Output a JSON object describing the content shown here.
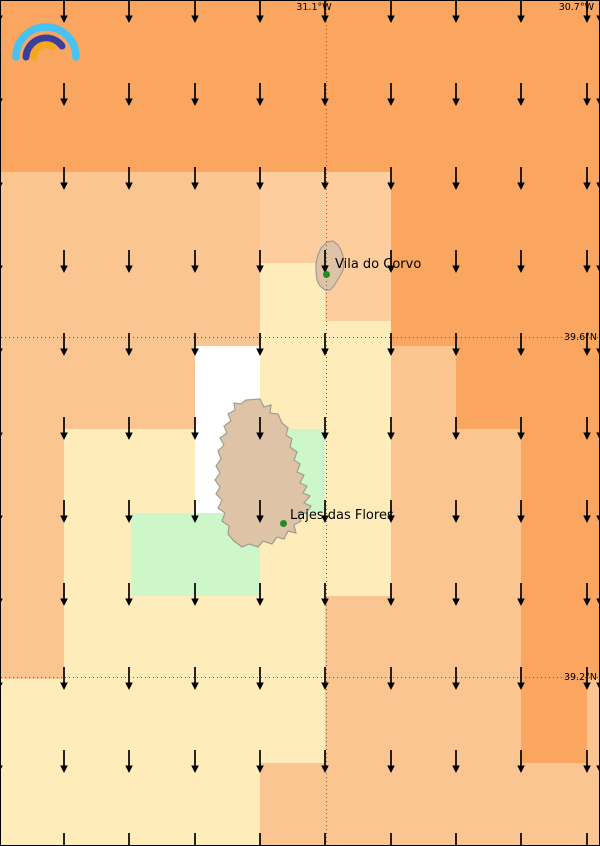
{
  "title": "Wind direction map - Corvo and Flores (Azores)",
  "logo": {
    "arcs": [
      {
        "id": "outer-light-blue",
        "d": "M11,48 A30,30 0 0 1 71,48",
        "color": "#47C2F1",
        "width": 7.5
      },
      {
        "id": "middle-dark-blue",
        "d": "M21,48 A20,20 0 0 1 57,37",
        "color": "#3A3F9E",
        "width": 7
      },
      {
        "id": "inner-yellow",
        "d": "M29,48 A12,12 0 0 1 48,38",
        "color": "#F4A81D",
        "width": 7
      }
    ]
  },
  "map": {
    "width": 600,
    "height": 846,
    "colors": {
      "orange": "#FAA661",
      "peach": "#FBC592",
      "peach_light": "#FECD9D",
      "cream": "#FEECBB",
      "green": "#CDF7C9",
      "white": "#FFFFFF",
      "island_fill": "#DFC3A7",
      "island_border": "#9E9E94",
      "place_dot": "#1E8E22",
      "gridline": "#60605A",
      "label_text": "#000000",
      "border": "#000000"
    },
    "base_color": "orange",
    "regions": [
      {
        "x": 0,
        "y": 171,
        "w": 390,
        "h": 174,
        "color": "peach"
      },
      {
        "x": 259,
        "y": 171,
        "w": 131,
        "h": 91,
        "color": "peach_light"
      },
      {
        "x": 324,
        "y": 262,
        "w": 66,
        "h": 58,
        "color": "peach_light"
      },
      {
        "x": 259,
        "y": 262,
        "w": 65,
        "h": 83,
        "color": "cream"
      },
      {
        "x": 324,
        "y": 320,
        "w": 66,
        "h": 25,
        "color": "cream"
      },
      {
        "x": 0,
        "y": 345,
        "w": 194,
        "h": 83,
        "color": "peach"
      },
      {
        "x": 259,
        "y": 345,
        "w": 131,
        "h": 83,
        "color": "cream"
      },
      {
        "x": 390,
        "y": 345,
        "w": 65,
        "h": 83,
        "color": "peach"
      },
      {
        "x": 194,
        "y": 345,
        "w": 65,
        "h": 167,
        "color": "white"
      },
      {
        "x": 0,
        "y": 428,
        "w": 63,
        "h": 250,
        "color": "peach"
      },
      {
        "x": 63,
        "y": 428,
        "w": 131,
        "h": 84,
        "color": "cream"
      },
      {
        "x": 259,
        "y": 428,
        "w": 65,
        "h": 84,
        "color": "green"
      },
      {
        "x": 324,
        "y": 428,
        "w": 66,
        "h": 167,
        "color": "cream"
      },
      {
        "x": 390,
        "y": 428,
        "w": 130,
        "h": 167,
        "color": "peach"
      },
      {
        "x": 63,
        "y": 512,
        "w": 67,
        "h": 83,
        "color": "cream"
      },
      {
        "x": 130,
        "y": 512,
        "w": 129,
        "h": 83,
        "color": "green"
      },
      {
        "x": 259,
        "y": 512,
        "w": 65,
        "h": 83,
        "color": "cream"
      },
      {
        "x": 63,
        "y": 595,
        "w": 261,
        "h": 83,
        "color": "cream"
      },
      {
        "x": 324,
        "y": 595,
        "w": 196,
        "h": 83,
        "color": "peach"
      },
      {
        "x": 0,
        "y": 678,
        "w": 324,
        "h": 84,
        "color": "cream"
      },
      {
        "x": 324,
        "y": 678,
        "w": 196,
        "h": 84,
        "color": "peach"
      },
      {
        "x": 586,
        "y": 678,
        "w": 14,
        "h": 84,
        "color": "peach"
      },
      {
        "x": 0,
        "y": 762,
        "w": 259,
        "h": 84,
        "color": "cream"
      },
      {
        "x": 259,
        "y": 762,
        "w": 341,
        "h": 84,
        "color": "peach"
      }
    ],
    "islands": [
      {
        "name": "Corvo",
        "path": "M326,241 L332,240 L337,244 L340,249 L342,255 L343,262 L342,269 L339,275 L336,280 L333,285 L329,289 L324,289 L319,285 L316,279 L315,271 L315,262 L317,254 L320,247 Z"
      },
      {
        "name": "Flores",
        "path": "M245,399 L259,398 L263,406 L270,404 L269,412 L277,413 L281,422 L287,427 L285,434 L291,438 L289,446 L296,451 L293,459 L299,463 L296,471 L303,474 L299,482 L306,485 L302,492 L309,495 L303,502 L310,505 L305,512 L297,512 L300,520 L293,524 L295,532 L287,530 L283,538 L276,536 L271,543 L262,540 L257,546 L248,543 L241,546 L233,540 L227,533 L228,525 L221,520 L224,512 L217,507 L221,499 L215,493 L219,486 L214,479 L219,472 L215,465 L220,458 L217,450 L223,444 L219,437 L226,432 L223,425 L230,420 L227,413 L234,409 L233,402 L240,403 Z"
      }
    ],
    "gridlines": {
      "vertical_x": [
        325
      ],
      "horizontal_y": [
        336,
        676
      ]
    },
    "coordinate_labels": [
      {
        "text": "31.1°W",
        "x": 313,
        "y": 1,
        "align": "center",
        "valign": "top"
      },
      {
        "text": "30.7°W",
        "x": 593,
        "y": 1,
        "align": "right",
        "valign": "top"
      },
      {
        "text": "39.6°N",
        "x": 596,
        "y": 336,
        "align": "right",
        "valign": "middle"
      },
      {
        "text": "39.2°N",
        "x": 596,
        "y": 676,
        "align": "right",
        "valign": "middle"
      }
    ],
    "places": [
      {
        "name": "Vila do Corvo",
        "dot_x": 325,
        "dot_y": 273,
        "label_x": 334,
        "label_y": 263
      },
      {
        "name": "Lajes das Flores",
        "dot_x": 282,
        "dot_y": 522,
        "label_x": 289,
        "label_y": 514
      }
    ],
    "wind_arrows": {
      "direction": "down",
      "cols_x": [
        -2,
        63,
        128,
        194,
        259,
        324,
        390,
        455,
        520,
        586,
        599
      ],
      "rows_y": [
        10,
        93,
        177,
        260,
        343,
        427,
        510,
        593,
        677,
        760,
        843
      ]
    }
  }
}
